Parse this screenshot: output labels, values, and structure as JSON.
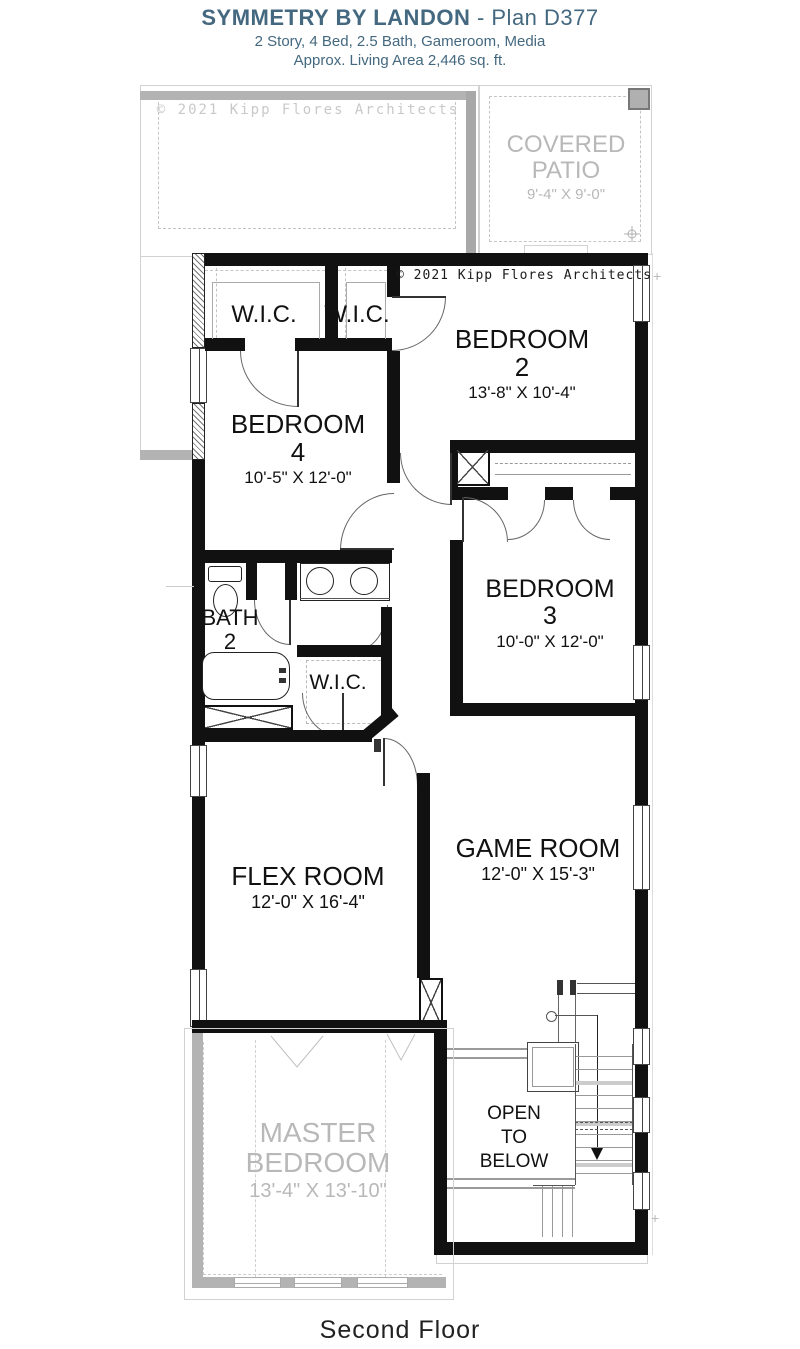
{
  "header": {
    "title_bold": "SYMMETRY BY LANDON",
    "title_rest": " - Plan D377",
    "subtitle1": "2 Story, 4 Bed, 2.5 Bath, Gameroom, Media",
    "subtitle2": "Approx. Living Area 2,446 sq. ft."
  },
  "copyright": {
    "first_floor_text": "© 2021 Kipp Flores Architects",
    "second_floor_text": "© 2021 Kipp Flores Architects"
  },
  "rooms": {
    "covered_patio": {
      "name_line1": "COVERED",
      "name_line2": "PATIO",
      "dims": "9'-4\" X 9'-0\""
    },
    "wic_bedroom4": {
      "name": "W.I.C."
    },
    "wic_bedroom2": {
      "name": "W.I.C."
    },
    "bedroom2": {
      "name": "BEDROOM",
      "number": "2",
      "dims": "13'-8\" X 10'-4\""
    },
    "bedroom4": {
      "name": "BEDROOM",
      "number": "4",
      "dims": "10'-5\" X 12'-0\""
    },
    "bedroom3": {
      "name": "BEDROOM",
      "number": "3",
      "dims": "10'-0\" X 12'-0\""
    },
    "bath2": {
      "name": "BATH",
      "number": "2"
    },
    "wic_hall": {
      "name": "W.I.C."
    },
    "flex": {
      "name": "FLEX ROOM",
      "dims": "12'-0\" X 16'-4\""
    },
    "game": {
      "name": "GAME ROOM",
      "dims": "12'-0\" X 15'-3\""
    },
    "open_to_below": {
      "line1": "OPEN",
      "line2": "TO",
      "line3": "BELOW"
    },
    "master": {
      "name_line1": "MASTER",
      "name_line2": "BEDROOM",
      "dims": "13'-4\" X 13'-10\""
    }
  },
  "footer": {
    "label": "Second Floor"
  },
  "icons": {
    "plus_marker": "+"
  },
  "colors": {
    "wall": "#111111",
    "first_floor_gray": "#b3b3b3",
    "outline_gray": "#d2d2d2",
    "label_gray": "#b8b8b8",
    "accent": "#44687F"
  }
}
